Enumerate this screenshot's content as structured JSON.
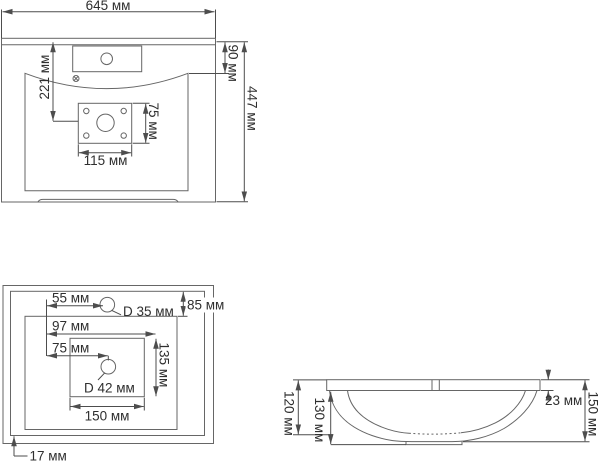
{
  "drawing": {
    "front": {
      "total_width": "645 мм",
      "ledge_height": "90 мм",
      "drain_center_from_top": "221 мм",
      "plate_height": "75 мм",
      "plate_width": "115 мм",
      "total_height": "447 мм"
    },
    "top": {
      "faucet_offset": "55 мм",
      "faucet_hole_diameter": "D 35 мм",
      "rim_depth": "85 мм",
      "drain_zone_offset": "97 мм",
      "drain_offset": "75 мм",
      "drain_zone_depth": "135 мм",
      "drain_hole_diameter": "D 42 мм",
      "drain_zone_width": "150 мм",
      "edge_offset": "17 мм"
    },
    "side": {
      "inner_depth": "120 мм",
      "outer_depth": "130 мм",
      "rim_thickness": "23 мм",
      "total_depth": "150 мм"
    },
    "colors": {
      "line": "#666666",
      "dim_line": "#4d4d4d",
      "text": "#2f2f2f",
      "background": "#ffffff"
    }
  }
}
